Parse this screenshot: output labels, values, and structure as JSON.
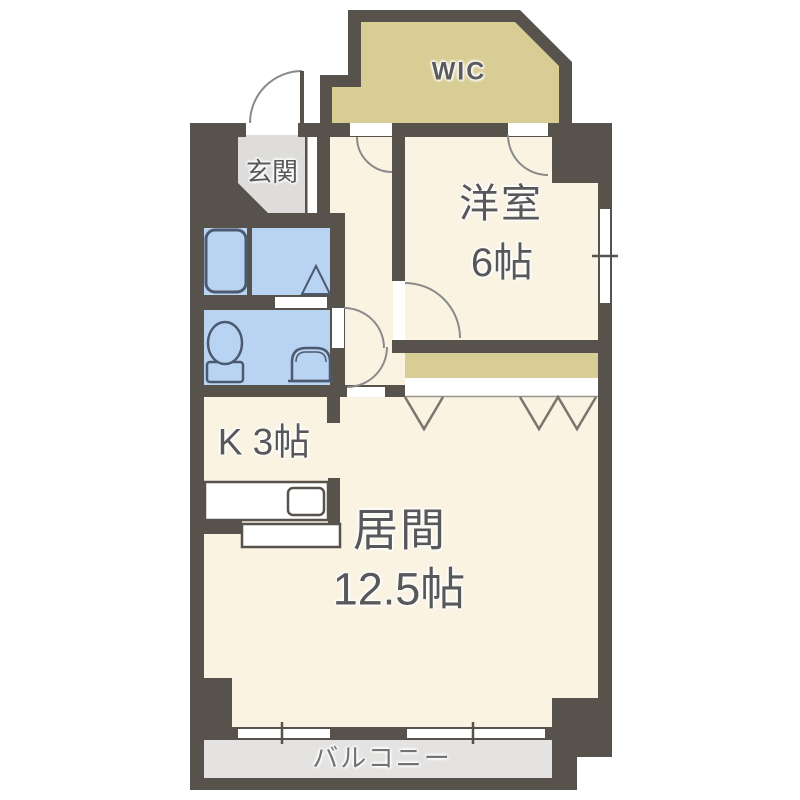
{
  "floorplan": {
    "rooms": {
      "wic": {
        "label": "WIC"
      },
      "genkan": {
        "label": "玄関"
      },
      "western_room": {
        "name": "洋室",
        "size": "6帖"
      },
      "kitchen": {
        "label": "K 3帖"
      },
      "living": {
        "name": "居間",
        "size": "12.5帖"
      },
      "balcony": {
        "label": "バルコニー"
      }
    },
    "colors": {
      "wall": "#57534c",
      "floor": "#faf3e2",
      "closet_tan": "#d8cd94",
      "wet_area_blue": "#b9d3f2",
      "entry_gray": "#dedddb",
      "balcony_gray": "#e4e3e1",
      "door_arc": "#8a8a8a",
      "fixture_stroke": "#4c5a70",
      "label_text": "#58585a"
    }
  }
}
